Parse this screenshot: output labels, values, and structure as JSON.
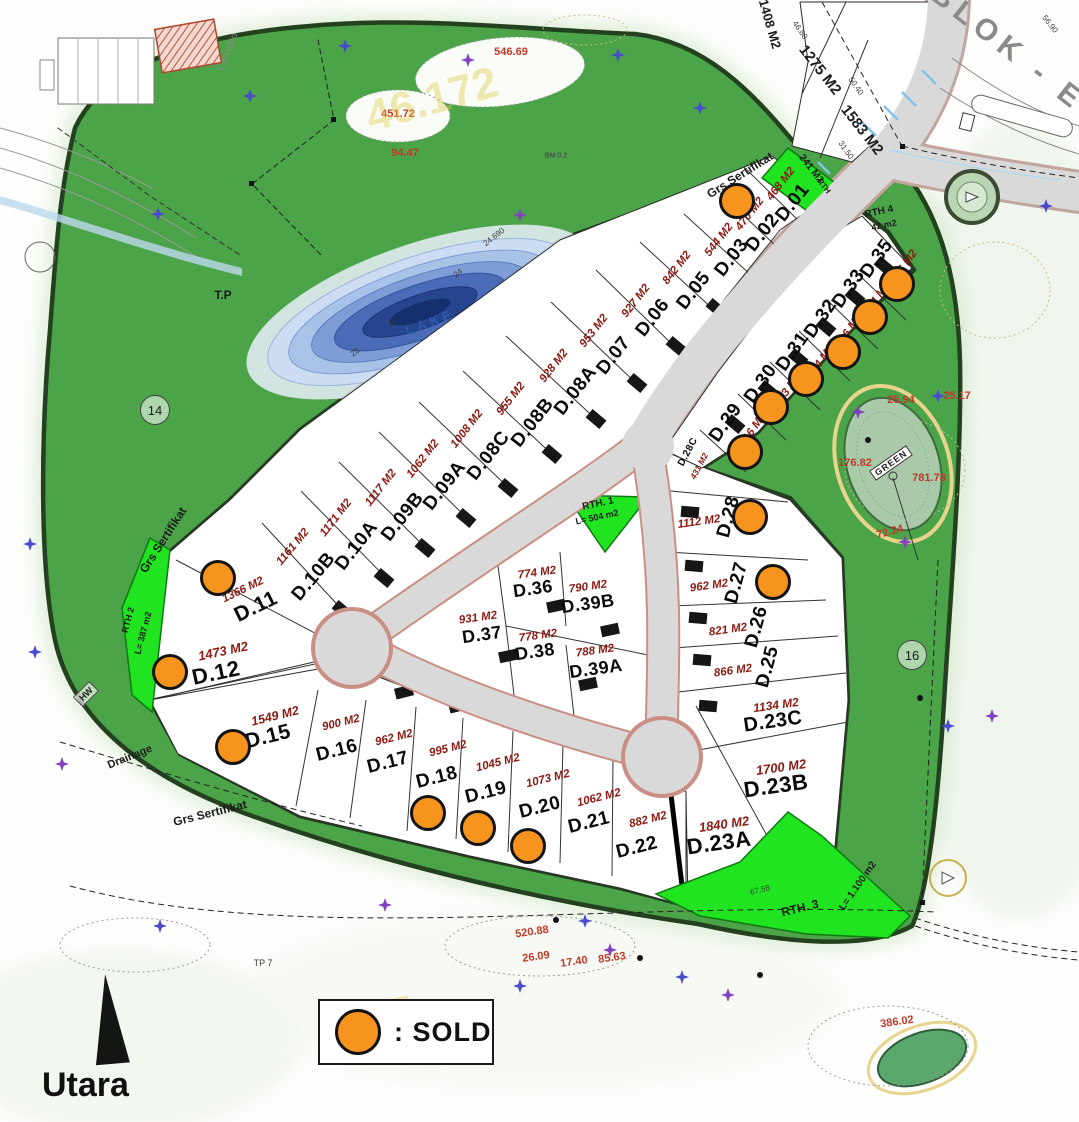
{
  "legend": {
    "sold_label": ": SOLD"
  },
  "compass": {
    "label": "Utara"
  },
  "blok_label": "BLOK - E",
  "colors": {
    "sold_orange": "#F7941E",
    "rth_bright_green": "#1FE41F",
    "belt_green": "#4CA449",
    "lake_blue": "#27458F",
    "area_text_red": "#8B1A12",
    "road_gray": "#D9D9D9"
  },
  "lots": [
    {
      "id": "D.01",
      "area": "468 M2",
      "x": 793,
      "y": 203,
      "r": -52,
      "ax": 781,
      "ay": 184
    },
    {
      "id": "D.02",
      "area": "470 M2",
      "x": 763,
      "y": 233,
      "r": -52,
      "ax": 750,
      "ay": 214,
      "sold": true,
      "sx": 737,
      "sy": 201
    },
    {
      "id": "D.03",
      "area": "544 M2",
      "x": 732,
      "y": 258,
      "r": -52,
      "ax": 719,
      "ay": 240
    },
    {
      "id": "D.05",
      "area": "842 M2",
      "x": 694,
      "y": 291,
      "r": -52,
      "ax": 677,
      "ay": 268
    },
    {
      "id": "D.06",
      "area": "927 M2",
      "x": 653,
      "y": 318,
      "r": -52,
      "ax": 636,
      "ay": 301
    },
    {
      "id": "D.07",
      "area": "953 M2",
      "x": 614,
      "y": 356,
      "r": -52,
      "ax": 594,
      "ay": 331
    },
    {
      "id": "D.08A",
      "area": "928 M2",
      "x": 576,
      "y": 391,
      "r": -52,
      "ax": 554,
      "ay": 366
    },
    {
      "id": "D.08B",
      "area": "955 M2",
      "x": 533,
      "y": 423,
      "r": -52,
      "ax": 511,
      "ay": 399
    },
    {
      "id": "D.08C",
      "area": "1008 M2",
      "x": 489,
      "y": 456,
      "r": -52,
      "ax": 467,
      "ay": 429
    },
    {
      "id": "D.09A",
      "area": "1062 M2",
      "x": 445,
      "y": 486,
      "r": -52,
      "ax": 423,
      "ay": 459
    },
    {
      "id": "D.09B",
      "area": "1117 M2",
      "x": 403,
      "y": 517,
      "r": -52,
      "ax": 381,
      "ay": 488
    },
    {
      "id": "D.10A",
      "area": "1171 M2",
      "x": 357,
      "y": 546,
      "r": -52,
      "ax": 336,
      "ay": 518
    },
    {
      "id": "D.10B",
      "area": "1161 M2",
      "x": 314,
      "y": 577,
      "r": -50,
      "ax": 293,
      "ay": 547
    },
    {
      "id": "D.11",
      "area": "1366 M2",
      "x": 256,
      "y": 607,
      "r": -26,
      "ax": 243,
      "ay": 590,
      "ar": -26,
      "sold": true,
      "sx": 218,
      "sy": 578,
      "ns": 21
    },
    {
      "id": "D.12",
      "area": "1473 M2",
      "x": 216,
      "y": 673,
      "r": -12,
      "ax": 223,
      "ay": 651,
      "ar": -12,
      "sold": true,
      "sx": 170,
      "sy": 672,
      "ns": 22,
      "as2": 13
    },
    {
      "id": "D.15",
      "area": "1549 M2",
      "x": 268,
      "y": 737,
      "r": -14,
      "ax": 275,
      "ay": 716,
      "ar": -14,
      "sold": true,
      "sx": 233,
      "sy": 747,
      "ns": 21,
      "as2": 12.5
    },
    {
      "id": "D.16",
      "area": "900 M2",
      "x": 337,
      "y": 751,
      "r": -14,
      "ax": 341,
      "ay": 723,
      "ar": -14
    },
    {
      "id": "D.17",
      "area": "962 M2",
      "x": 388,
      "y": 763,
      "r": -14,
      "ax": 394,
      "ay": 738,
      "ar": -14
    },
    {
      "id": "D.18",
      "area": "995 M2",
      "x": 437,
      "y": 778,
      "r": -14,
      "ax": 448,
      "ay": 749,
      "ar": -14,
      "sold": true,
      "sx": 428,
      "sy": 813
    },
    {
      "id": "D.19",
      "area": "1045 M2",
      "x": 486,
      "y": 793,
      "r": -14,
      "ax": 498,
      "ay": 763,
      "ar": -14,
      "sold": true,
      "sx": 478,
      "sy": 828
    },
    {
      "id": "D.20",
      "area": "1073 M2",
      "x": 540,
      "y": 808,
      "r": -14,
      "ax": 548,
      "ay": 779,
      "ar": -14,
      "sold": true,
      "sx": 528,
      "sy": 846
    },
    {
      "id": "D.21",
      "area": "1062 M2",
      "x": 589,
      "y": 823,
      "r": -14,
      "ax": 599,
      "ay": 798,
      "ar": -14
    },
    {
      "id": "D.22",
      "area": "882 M2",
      "x": 637,
      "y": 848,
      "r": -14,
      "ax": 648,
      "ay": 820,
      "ar": -14
    },
    {
      "id": "D.23A",
      "area": "1840 M2",
      "x": 719,
      "y": 843,
      "r": -8,
      "ax": 724,
      "ay": 824,
      "ar": -8,
      "ns": 22,
      "as2": 13
    },
    {
      "id": "D.23B",
      "area": "1700 M2",
      "x": 776,
      "y": 786,
      "r": -8,
      "ax": 781,
      "ay": 767,
      "ar": -8,
      "ns": 22,
      "as2": 13
    },
    {
      "id": "D.23C",
      "area": "1134 M2",
      "x": 773,
      "y": 722,
      "r": -8,
      "ax": 776,
      "ay": 705,
      "ar": -8,
      "ns": 20,
      "as2": 12
    },
    {
      "id": "D.25",
      "area": "866 M2",
      "x": 768,
      "y": 667,
      "r": -75,
      "ax": 733,
      "ay": 671,
      "ar": -8
    },
    {
      "id": "D.26",
      "area": "821 M2",
      "x": 757,
      "y": 627,
      "r": -75,
      "ax": 728,
      "ay": 630,
      "ar": -8
    },
    {
      "id": "D.27",
      "area": "962 M2",
      "x": 737,
      "y": 583,
      "r": -75,
      "ax": 709,
      "ay": 586,
      "ar": -8,
      "sold": true,
      "sx": 773,
      "sy": 582
    },
    {
      "id": "D.28",
      "area": "1112 M2",
      "x": 729,
      "y": 517,
      "r": -75,
      "ax": 699,
      "ay": 522,
      "ar": -8,
      "sold": true,
      "sx": 750,
      "sy": 517
    },
    {
      "id": "D.28C",
      "area": "431 M2",
      "x": 688,
      "y": 452,
      "r": -62,
      "ax": 699,
      "ay": 466,
      "ar": -62,
      "ns": 10,
      "as2": 8.5
    },
    {
      "id": "D.29",
      "area": "616 M2",
      "x": 726,
      "y": 423,
      "r": -55,
      "ax": 753,
      "ay": 430,
      "sold": true,
      "sx": 745,
      "sy": 452
    },
    {
      "id": "D.30",
      "area": "533 M2",
      "x": 761,
      "y": 384,
      "r": -55,
      "ax": 788,
      "ay": 390,
      "sold": true,
      "sx": 771,
      "sy": 407
    },
    {
      "id": "D.31",
      "area": "504 M2",
      "x": 793,
      "y": 352,
      "r": -55,
      "ax": 821,
      "ay": 362,
      "sold": true,
      "sx": 806,
      "sy": 379
    },
    {
      "id": "D.32",
      "area": "536 M2",
      "x": 821,
      "y": 319,
      "r": -55,
      "ax": 849,
      "ay": 331,
      "sold": true,
      "sx": 843,
      "sy": 352
    },
    {
      "id": "D.33",
      "area": "524 M2",
      "x": 849,
      "y": 289,
      "r": -55,
      "ax": 877,
      "ay": 299,
      "sold": true,
      "sx": 870,
      "sy": 317
    },
    {
      "id": "D.35",
      "area": "476 M2",
      "x": 877,
      "y": 259,
      "r": -55,
      "ax": 904,
      "ay": 267,
      "sold": true,
      "sx": 897,
      "sy": 284
    },
    {
      "id": "D.36",
      "area": "774 M2",
      "x": 533,
      "y": 589,
      "r": -8,
      "ax": 537,
      "ay": 573,
      "ar": -8,
      "ns": 18
    },
    {
      "id": "D.37",
      "area": "931 M2",
      "x": 482,
      "y": 635,
      "r": -8,
      "ax": 478,
      "ay": 618,
      "ar": -8,
      "ns": 18
    },
    {
      "id": "D.38",
      "area": "778 M2",
      "x": 535,
      "y": 652,
      "r": -8,
      "ax": 538,
      "ay": 636,
      "ar": -8,
      "ns": 18
    },
    {
      "id": "D.39A",
      "area": "788 M2",
      "x": 596,
      "y": 669,
      "r": -8,
      "ax": 595,
      "ay": 651,
      "ar": -8,
      "ns": 18
    },
    {
      "id": "D.39B",
      "area": "790 M2",
      "x": 588,
      "y": 604,
      "r": -8,
      "ax": 588,
      "ay": 587,
      "ar": -8,
      "ns": 18
    }
  ],
  "map_labels": [
    {
      "t": "1408 M2",
      "x": 770,
      "y": 24,
      "r": 74,
      "s": 13
    },
    {
      "t": "1275 M2",
      "x": 820,
      "y": 70,
      "r": 52,
      "s": 15
    },
    {
      "t": "1583 M2",
      "x": 862,
      "y": 130,
      "r": 52,
      "s": 15
    },
    {
      "t": "241 M2",
      "x": 811,
      "y": 169,
      "r": 52,
      "s": 10
    },
    {
      "t": "RTH",
      "x": 824,
      "y": 186,
      "r": 52,
      "s": 8
    },
    {
      "t": "RTH 4",
      "x": 879,
      "y": 212,
      "r": -12,
      "s": 10
    },
    {
      "t": "42 m2",
      "x": 884,
      "y": 225,
      "r": -12,
      "s": 9
    },
    {
      "t": "46.80",
      "x": 800,
      "y": 30,
      "r": 55,
      "c": "dim"
    },
    {
      "t": "50.40",
      "x": 856,
      "y": 86,
      "r": 55,
      "c": "dim"
    },
    {
      "t": "31.50",
      "x": 846,
      "y": 150,
      "r": 55,
      "c": "dim"
    },
    {
      "t": "56.90",
      "x": 1050,
      "y": 24,
      "r": 52,
      "c": "dim"
    },
    {
      "t": "67.58",
      "x": 760,
      "y": 890,
      "r": -14,
      "c": "dim"
    },
    {
      "t": "Grs Sertifikat",
      "x": 740,
      "y": 175,
      "r": -32,
      "s": 12
    },
    {
      "t": "Grs Sertifikat",
      "x": 163,
      "y": 540,
      "r": -57,
      "s": 12
    },
    {
      "t": "Grs Sertifikat",
      "x": 210,
      "y": 813,
      "r": -14,
      "s": 12
    },
    {
      "t": "T.P",
      "x": 223,
      "y": 295,
      "s": 12
    },
    {
      "t": "14",
      "x": 155,
      "y": 410,
      "c": "circ"
    },
    {
      "t": "16",
      "x": 912,
      "y": 655,
      "c": "circ"
    },
    {
      "t": "LAKE",
      "x": 430,
      "y": 322,
      "r": -20,
      "s": 13,
      "c": "blue"
    },
    {
      "t": "22",
      "x": 355,
      "y": 352,
      "r": -38,
      "c": "dim"
    },
    {
      "t": "23",
      "x": 392,
      "y": 322,
      "r": -38,
      "c": "dim"
    },
    {
      "t": "24",
      "x": 458,
      "y": 273,
      "r": -38,
      "c": "dim"
    },
    {
      "t": "24.690",
      "x": 494,
      "y": 237,
      "r": -38,
      "c": "dim"
    },
    {
      "t": "RTH. 1",
      "x": 598,
      "y": 504,
      "r": -12,
      "s": 10
    },
    {
      "t": "L= 504 m2",
      "x": 597,
      "y": 517,
      "r": -12,
      "s": 9
    },
    {
      "t": "RTH 2",
      "x": 128,
      "y": 620,
      "r": -75,
      "s": 9
    },
    {
      "t": "L= 387 m2",
      "x": 143,
      "y": 633,
      "r": -75,
      "s": 9
    },
    {
      "t": "RTH. 3",
      "x": 800,
      "y": 908,
      "r": -14,
      "s": 12
    },
    {
      "t": "L= 1.100 m2",
      "x": 858,
      "y": 886,
      "r": -55,
      "s": 10
    },
    {
      "t": "Drainage",
      "x": 130,
      "y": 757,
      "r": -22,
      "s": 11
    },
    {
      "t": "HW",
      "x": 86,
      "y": 694,
      "r": -45,
      "c": "diam"
    },
    {
      "t": "GREEN",
      "x": 891,
      "y": 463,
      "r": -35,
      "c": "greenlab"
    },
    {
      "t": "546.69",
      "x": 511,
      "y": 52,
      "c": "red"
    },
    {
      "t": "451.72",
      "x": 398,
      "y": 114,
      "c": "red"
    },
    {
      "t": "94.47",
      "x": 405,
      "y": 153,
      "c": "red"
    },
    {
      "t": "25.94",
      "x": 901,
      "y": 400,
      "c": "red"
    },
    {
      "t": "25.17",
      "x": 957,
      "y": 396,
      "c": "red"
    },
    {
      "t": "176.82",
      "x": 855,
      "y": 463,
      "c": "red"
    },
    {
      "t": "781.78",
      "x": 929,
      "y": 478,
      "c": "red"
    },
    {
      "t": "72.24",
      "x": 890,
      "y": 532,
      "r": -15,
      "c": "red"
    },
    {
      "t": "520.88",
      "x": 532,
      "y": 932,
      "r": -8,
      "c": "red"
    },
    {
      "t": "26.09",
      "x": 536,
      "y": 957,
      "r": -8,
      "c": "red"
    },
    {
      "t": "17.40",
      "x": 574,
      "y": 962,
      "r": -8,
      "c": "red"
    },
    {
      "t": "85.63",
      "x": 612,
      "y": 958,
      "r": -8,
      "c": "red"
    },
    {
      "t": "386.02",
      "x": 897,
      "y": 1022,
      "r": -8,
      "c": "red"
    },
    {
      "t": "TP 7",
      "x": 263,
      "y": 963,
      "s": 9,
      "c": "dim"
    },
    {
      "t": "Carvalho",
      "x": 228,
      "y": 52,
      "r": -68,
      "s": 10,
      "c": "gray"
    },
    {
      "t": "BM 0.2",
      "x": 556,
      "y": 156,
      "s": 7,
      "c": "dim"
    },
    {
      "t": "46.172",
      "x": 432,
      "y": 100,
      "r": -16,
      "s": 44,
      "c": "wm"
    },
    {
      "t": "29.577",
      "x": 368,
      "y": 1012,
      "r": -8,
      "s": 28,
      "c": "wm"
    }
  ]
}
